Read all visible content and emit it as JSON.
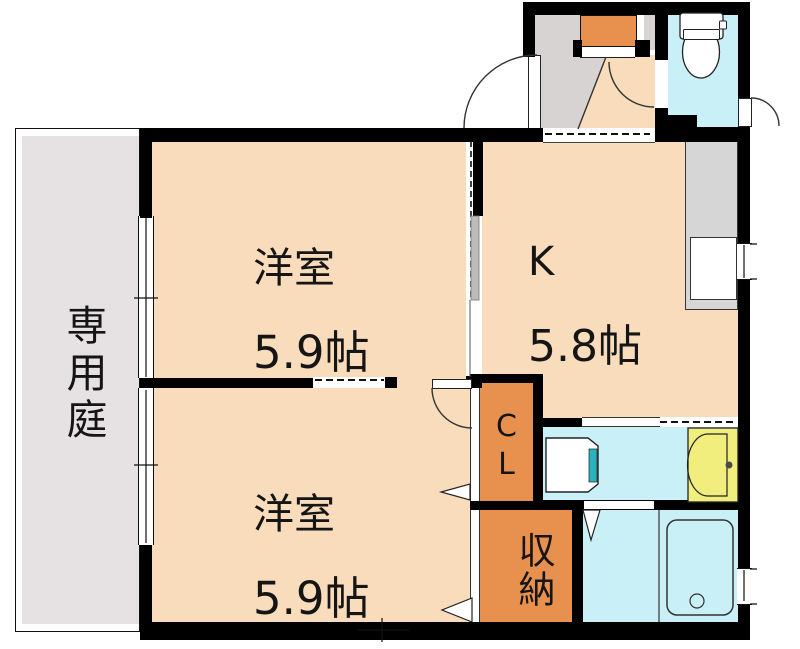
{
  "rooms": {
    "garden": {
      "label": "専用庭"
    },
    "room_top": {
      "name": "洋室",
      "size": "5.9帖"
    },
    "kitchen": {
      "name": "K",
      "size": "5.8帖"
    },
    "room_bottom": {
      "name": "洋室",
      "size": "5.9帖"
    },
    "closet": {
      "label": "CL"
    },
    "storage": {
      "label": "収納"
    }
  },
  "colors": {
    "room-floor": "#f8dcbb",
    "closet-orange": "#e8914e",
    "wet-cyan": "#c9f0f7",
    "vanity-yellow": "#f1ee7e",
    "washer-teal": "#2ab3bf",
    "entrance-gray": "#d8d3d3",
    "garden-gray": "#e6e2e3",
    "counter-gray": "#d6d6d6",
    "wall-black": "#000000",
    "line": "#222222"
  }
}
